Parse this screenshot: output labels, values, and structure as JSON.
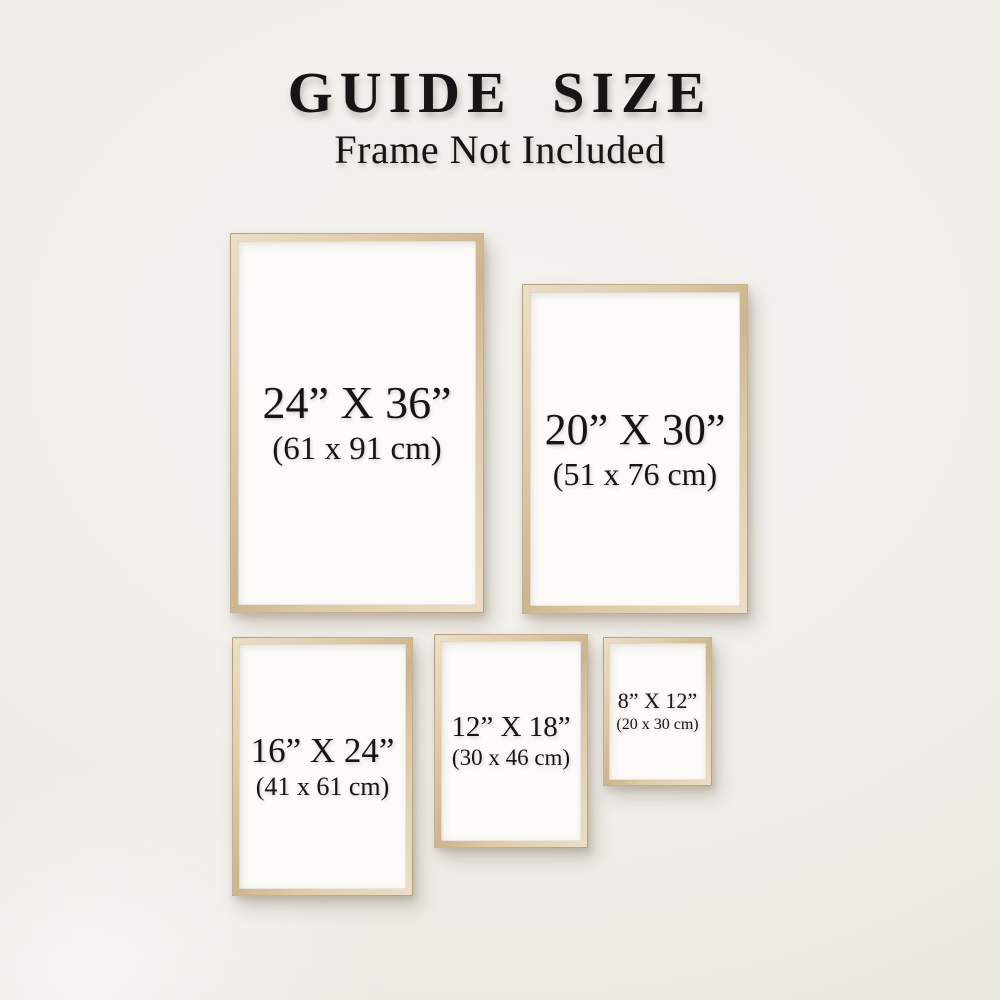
{
  "header": {
    "title": "GUIDE SIZE",
    "subtitle": "Frame Not Included"
  },
  "frames": [
    {
      "name": "24x36",
      "inches": "24” X 36”",
      "cm": "(61 x 91 cm)"
    },
    {
      "name": "20x30",
      "inches": "20” X 30”",
      "cm": "(51 x 76 cm)"
    },
    {
      "name": "16x24",
      "inches": "16” X 24”",
      "cm": "(41 x 61 cm)"
    },
    {
      "name": "12x18",
      "inches": "12” X 18”",
      "cm": "(30 x 46 cm)"
    },
    {
      "name": "8x12",
      "inches": "8” X 12”",
      "cm": "(20 x 30 cm)"
    }
  ],
  "colors": {
    "wall": "#f1efea",
    "wall_light": "#f4f2ee",
    "wall_dark": "#ebe8e1",
    "wood": "#ddc9a7",
    "wood_light": "#ecdfc6",
    "wood_dark": "#ccb48d",
    "paper": "#fcfbf8",
    "text": "#171513"
  }
}
